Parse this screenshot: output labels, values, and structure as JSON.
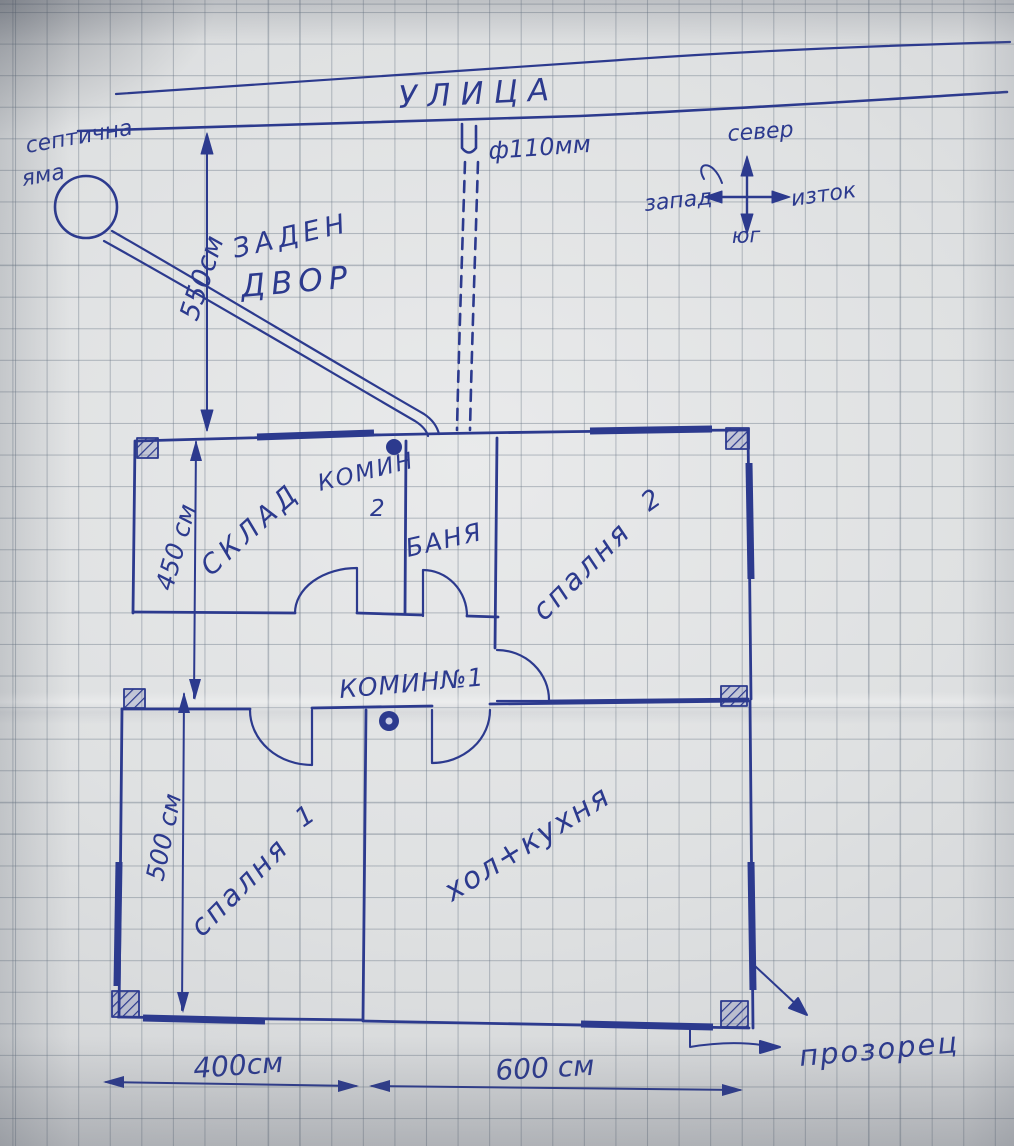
{
  "street": {
    "label": "УЛИЦА"
  },
  "septic_pit": {
    "line1": "септична",
    "line2": "яма"
  },
  "back_yard": {
    "line1": "ЗАДЕН",
    "line2": "ДВОР"
  },
  "sewer_pipe": {
    "label": "ф110мм"
  },
  "compass": {
    "north": "север",
    "south": "юг",
    "west": "запад",
    "east": "изток"
  },
  "rooms": {
    "storage": "СКЛАД",
    "bath": "БАНЯ",
    "bedroom2_word": "спалня",
    "bedroom2_num": "2",
    "bedroom1_word": "спалня",
    "bedroom1_num": "1",
    "living_kitchen": "хол+кухня"
  },
  "chimneys": {
    "chimney2_line1": "КОМИН",
    "chimney2_line2": "2",
    "chimney1": "КОМИН№1"
  },
  "dimensions": {
    "yard_depth": "550см",
    "upper_height": "450 см",
    "lower_height": "500 см",
    "width_left": "400см",
    "width_right": "600 см"
  },
  "annotations": {
    "window": "прозорец"
  },
  "colors": {
    "ink": "#2c3a8e",
    "paper": "#dcdedf",
    "grid": "#8f9aa6"
  }
}
